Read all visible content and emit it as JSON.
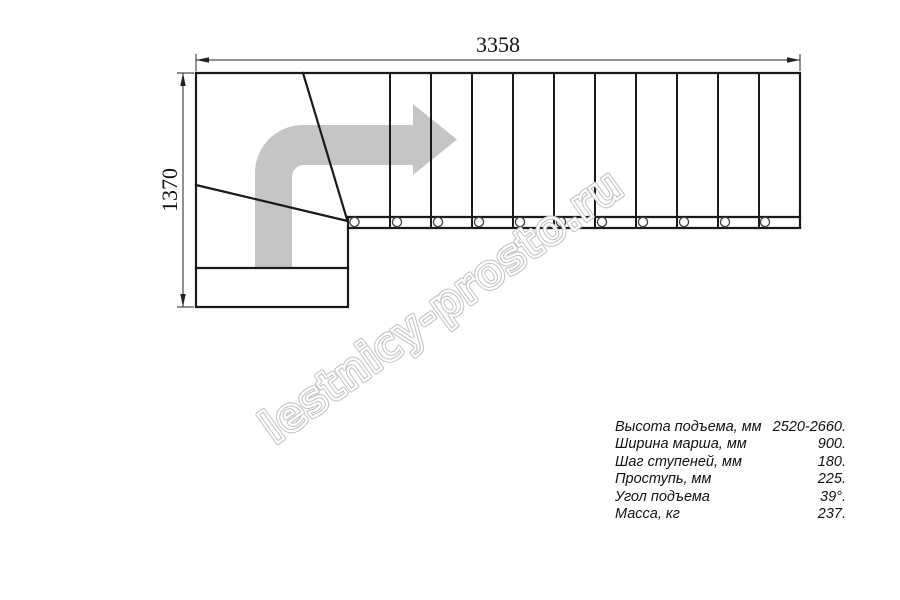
{
  "drawing": {
    "top_dimension": "3358",
    "left_dimension": "1370",
    "watermark": "lestnicy-prosto.ru",
    "colors": {
      "line": "#1a1a1a",
      "direction_arrow": "#c5c5c5",
      "watermark_outline": "#c3c3c3"
    },
    "icons": [
      "direction-arrow-icon"
    ]
  },
  "specs": {
    "rows": [
      {
        "label": "Высота подъема, мм",
        "value": "2520-2660."
      },
      {
        "label": "Ширина марша, мм",
        "value": "900."
      },
      {
        "label": "Шаг ступеней, мм",
        "value": "180."
      },
      {
        "label": "Проступь, мм",
        "value": "225."
      },
      {
        "label": "Угол подъема",
        "value": "39°."
      },
      {
        "label": "Масса, кг",
        "value": "237."
      }
    ]
  }
}
